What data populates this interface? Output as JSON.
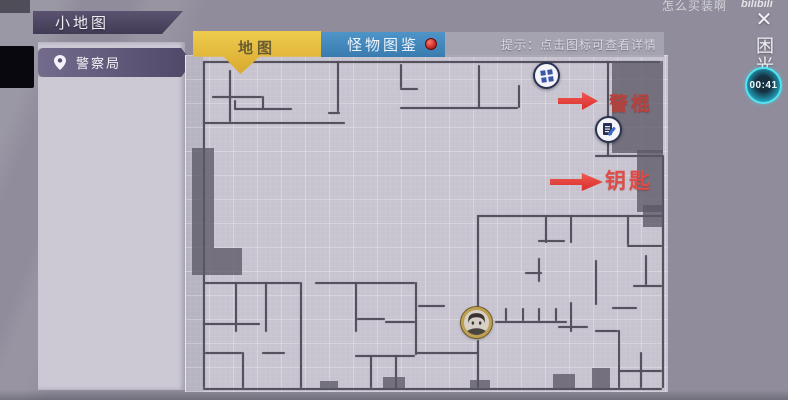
{
  "window": {
    "title": "小地图"
  },
  "sidebar": {
    "items": [
      {
        "label": "警察局"
      }
    ]
  },
  "tabs": [
    {
      "label": "地图",
      "active": true,
      "color": "#e3b93d"
    },
    {
      "label": "怪物图鉴",
      "active": false,
      "badge": true,
      "color": "#4189bd",
      "badge_color": "#c01f1f"
    }
  ],
  "hint": "提示：点击图标可查看详情",
  "watermark": {
    "text": "怎么买装啊",
    "brand": "bilibili"
  },
  "icons": {
    "close": "✕"
  },
  "right_rail": {
    "vertical_label": "困光",
    "timer": "00:41",
    "timer_color": "#3fd6e8"
  },
  "map": {
    "location": "警察局",
    "annotations": [
      {
        "label": "警棍",
        "color": "#b8413c"
      },
      {
        "label": "钥匙",
        "color": "#e14b45"
      }
    ],
    "markers": [
      {
        "name": "baton-item-icon"
      },
      {
        "name": "document-item-icon"
      },
      {
        "name": "player-avatar"
      }
    ],
    "colors": {
      "floor": "#c7c4d0",
      "wall": "#55525e",
      "fog": "#5c5967",
      "arrow": "#d92f2c"
    },
    "walls": [
      [
        18,
        6,
        457,
        "h"
      ],
      [
        18,
        6,
        327,
        "v"
      ],
      [
        18,
        333,
        459,
        "h"
      ],
      [
        477,
        100,
        233,
        "v"
      ],
      [
        422,
        6,
        96,
        "v"
      ],
      [
        410,
        100,
        67,
        "h"
      ],
      [
        44,
        15,
        52,
        "v"
      ],
      [
        18,
        67,
        142,
        "h"
      ],
      [
        27,
        41,
        50,
        "h"
      ],
      [
        77,
        41,
        14,
        "v"
      ],
      [
        49,
        53,
        58,
        "h"
      ],
      [
        49,
        45,
        9,
        "v"
      ],
      [
        152,
        6,
        51,
        "v"
      ],
      [
        143,
        57,
        12,
        "h"
      ],
      [
        215,
        9,
        24,
        "v"
      ],
      [
        215,
        33,
        18,
        "h"
      ],
      [
        215,
        52,
        118,
        "h"
      ],
      [
        293,
        10,
        43,
        "v"
      ],
      [
        333,
        30,
        23,
        "v"
      ],
      [
        292,
        160,
        186,
        "h"
      ],
      [
        292,
        160,
        92,
        "v"
      ],
      [
        360,
        160,
        28,
        "v"
      ],
      [
        353,
        185,
        27,
        "h"
      ],
      [
        385,
        160,
        28,
        "v"
      ],
      [
        442,
        160,
        30,
        "v"
      ],
      [
        442,
        190,
        35,
        "h"
      ],
      [
        410,
        205,
        45,
        "v"
      ],
      [
        427,
        252,
        25,
        "h"
      ],
      [
        448,
        230,
        29,
        "h"
      ],
      [
        460,
        200,
        30,
        "v"
      ],
      [
        433,
        275,
        58,
        "v"
      ],
      [
        433,
        315,
        44,
        "h"
      ],
      [
        455,
        297,
        36,
        "v"
      ],
      [
        410,
        275,
        23,
        "h"
      ],
      [
        18,
        227,
        97,
        "h"
      ],
      [
        130,
        227,
        100,
        "h"
      ],
      [
        50,
        227,
        50,
        "v"
      ],
      [
        80,
        227,
        50,
        "v"
      ],
      [
        115,
        227,
        106,
        "v"
      ],
      [
        18,
        268,
        57,
        "h"
      ],
      [
        20,
        297,
        37,
        "h"
      ],
      [
        77,
        297,
        23,
        "h"
      ],
      [
        57,
        297,
        36,
        "v"
      ],
      [
        170,
        227,
        50,
        "v"
      ],
      [
        172,
        263,
        28,
        "h"
      ],
      [
        200,
        266,
        30,
        "h"
      ],
      [
        230,
        227,
        73,
        "v"
      ],
      [
        170,
        300,
        60,
        "h"
      ],
      [
        185,
        300,
        33,
        "v"
      ],
      [
        210,
        300,
        33,
        "v"
      ],
      [
        230,
        297,
        63,
        "h"
      ],
      [
        292,
        285,
        48,
        "v"
      ],
      [
        310,
        266,
        72,
        "h"
      ],
      [
        320,
        253,
        13,
        "v"
      ],
      [
        337,
        253,
        13,
        "v"
      ],
      [
        353,
        253,
        13,
        "v"
      ],
      [
        370,
        253,
        13,
        "v"
      ],
      [
        233,
        250,
        27,
        "h"
      ],
      [
        353,
        203,
        24,
        "v"
      ],
      [
        340,
        217,
        17,
        "h"
      ],
      [
        385,
        247,
        30,
        "v"
      ],
      [
        373,
        271,
        30,
        "h"
      ]
    ],
    "fog": [
      [
        427,
        6,
        51,
        92
      ],
      [
        452,
        95,
        26,
        62
      ],
      [
        458,
        150,
        20,
        22
      ],
      [
        7,
        93,
        22,
        127
      ],
      [
        29,
        193,
        28,
        27
      ],
      [
        198,
        322,
        22,
        11
      ],
      [
        285,
        325,
        20,
        9
      ],
      [
        368,
        319,
        22,
        14
      ],
      [
        407,
        313,
        18,
        20
      ],
      [
        135,
        326,
        18,
        8
      ]
    ]
  }
}
